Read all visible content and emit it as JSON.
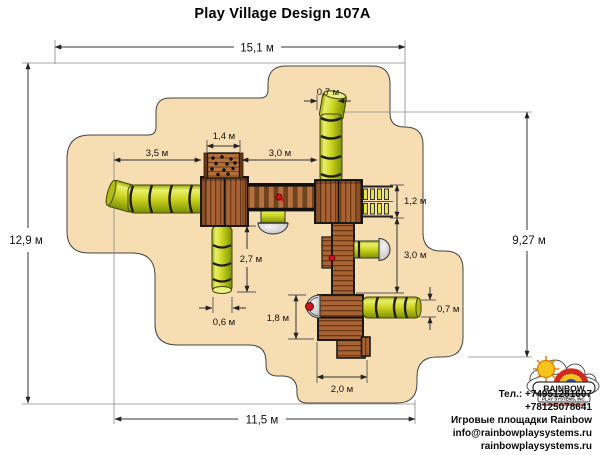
{
  "title": "Play Village Design 107A",
  "dims": {
    "overall_width": "15,1 м",
    "left_height": "12,9 м",
    "bottom_width": "11,5 м",
    "right_height": "9,27 м",
    "slide_left": "3,5 м",
    "wall_width": "1,4 м",
    "bridge_span": "3,0 м",
    "tube_top_width": "0,7 м",
    "ladder_height": "1,2 м",
    "walkway_length": "3,0 м",
    "slide_down_length": "2,7 м",
    "slide_down_width": "0,6 м",
    "platform_height": "1,8 м",
    "tube_right_width": "0,7 м",
    "platform_width": "2,0 м"
  },
  "logo": {
    "brand": "RAINBOW",
    "subtitle": "PLAY SYSTEMS, INC."
  },
  "contact": {
    "phone_primary": "Тел.: +74951281607",
    "phone_secondary": "+78125078641",
    "company": "Игровые площадки Rainbow",
    "email": "info@rainbowplaysystems.ru",
    "website": "rainbowplaysystems.ru"
  },
  "colors": {
    "safety_zone": "#f6ddb2",
    "tube": "#ccd51f",
    "wood": "#a96233",
    "dimension_line": "#333333",
    "logo_red": "#d42a1e"
  }
}
